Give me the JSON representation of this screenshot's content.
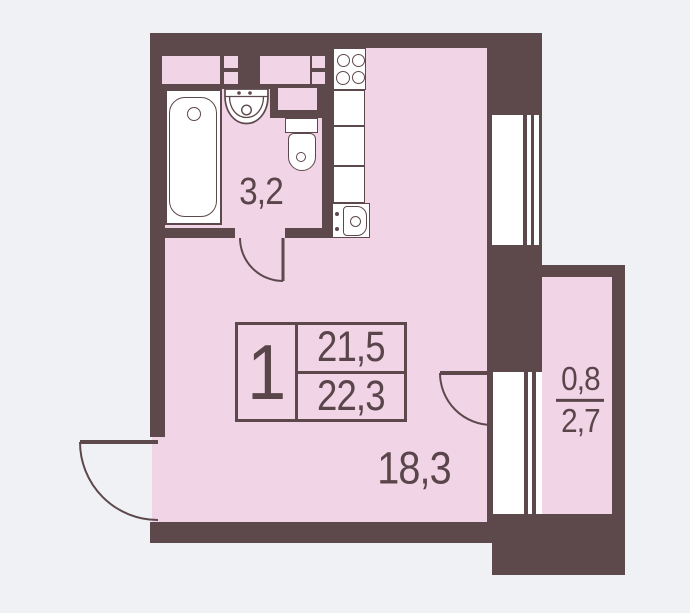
{
  "plan_title": "Studio apartment floor plan",
  "colors": {
    "wall": "#5d484c",
    "room_fill": "#f2d4e7",
    "background": "#eff1f4",
    "fixture_fill": "#ffffff",
    "text": "#5a464a"
  },
  "rooms": {
    "bathroom": {
      "area": "3,2"
    },
    "living_room": {
      "area": "18,3"
    },
    "balcony": {
      "area_reduced": "0,8",
      "area_full": "2,7"
    }
  },
  "info_box": {
    "room_count": "1",
    "living_area": "21,5",
    "total_area": "22,3"
  },
  "fixtures": [
    "bathtub",
    "bathroom-sink",
    "toilet",
    "vent-duct",
    "stove",
    "kitchen-counter",
    "kitchen-sink",
    "window",
    "balcony-door",
    "bathroom-door",
    "entrance-door"
  ]
}
